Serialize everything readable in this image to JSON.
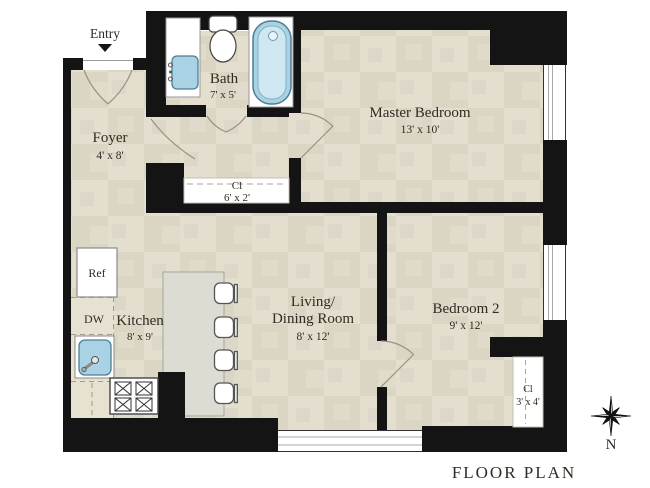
{
  "title": "FLOOR PLAN",
  "compass": {
    "label": "N"
  },
  "entry": {
    "label": "Entry"
  },
  "rooms": {
    "foyer": {
      "name": "Foyer",
      "dims": "4' x 8'"
    },
    "bath": {
      "name": "Bath",
      "dims": "7' x 5'"
    },
    "master_bedroom": {
      "name": "Master Bedroom",
      "dims": "13' x 10'"
    },
    "bedroom2": {
      "name": "Bedroom 2",
      "dims": "9' x 12'"
    },
    "living_dining": {
      "line1": "Living/",
      "line2": "Dining Room",
      "dims": "8' x 12'"
    },
    "kitchen": {
      "name": "Kitchen",
      "dims": "8' x 9'"
    },
    "hall_closet": {
      "name": "Cl",
      "dims": "6' x 2'"
    },
    "bedroom2_closet": {
      "name": "Cl",
      "dims": "3' x 4'"
    }
  },
  "appliances": {
    "refrigerator": "Ref",
    "dishwasher": "DW"
  },
  "colors": {
    "wall": "#141414",
    "floor": "#e4decf",
    "floor_alt": "#dbd5c3",
    "island": "#dcdcd3",
    "fixture_fill": "#a9d3e4",
    "fixture_light": "#cfe7f1",
    "fixture_stroke": "#4e7d94",
    "door_arc": "#99927e",
    "text": "#302b24"
  }
}
